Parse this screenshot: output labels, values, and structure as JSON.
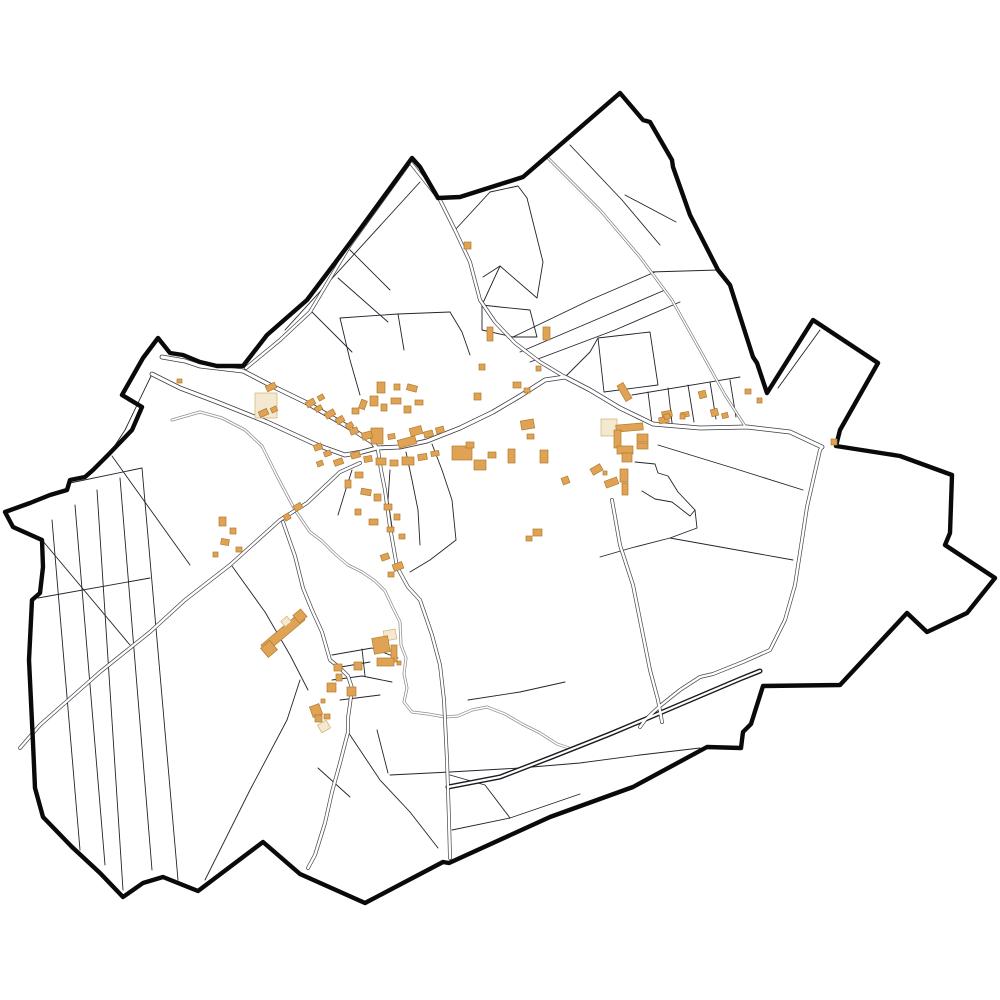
{
  "map": {
    "kind": "cadastral-commune-map",
    "background": "#ffffff",
    "colors": {
      "boundary": "#0a0a0a",
      "parcel": "#23232e",
      "road_inner": "#ffffff",
      "stream_casing": "#8f8f8f",
      "building_fill": "#e0a254",
      "building_stroke": "#b07c2e",
      "building_pale_fill": "#f4e8d0",
      "building_pale_stroke": "#cdb273"
    },
    "road_styles": {
      "major": {
        "casing": "#3a3a44",
        "cw": 4.8,
        "iw": 3.2
      },
      "minor": {
        "casing": "#44444c",
        "cw": 3.8,
        "iw": 2.4
      },
      "dark": {
        "casing": "#1b1b20",
        "cw": 5.0,
        "iw": 2.2
      },
      "track": {
        "casing": "#707070",
        "cw": 2.8,
        "iw": 1.5
      }
    },
    "boundary": "158,338 170,353 183,355 200,362 217,366 243,366 267,335 307,300 350,243 412,158 420,167 438,198 460,197 523,177 620,93 643,120 650,122 672,160 673,167 690,215 718,270 730,285 753,357 757,363 762,378 767,393 813,320 878,363 840,430 836,446 900,456 952,475 950,533 945,545 995,578 967,613 927,632 907,613 840,685 763,686 751,724 743,732 741,748 707,747 633,787 550,817 449,863 443,862 365,903 300,874 263,842 198,891 163,877 143,883 123,897 100,873 72,847 43,817 35,788 33,743 29,660 32,600 40,593 43,567 42,540 13,527 5,512 30,503 50,495 67,490 70,480 85,477 93,470 108,455 132,430 142,407 122,395 143,358",
    "roads": [
      {
        "name": "road-northwest-boundary",
        "style": "major",
        "points": "162,357 185,361 200,366 243,371 270,385 307,403 350,428 372,442 377,448"
      },
      {
        "name": "road-west-approach",
        "style": "major",
        "points": "152,374 180,388 217,402 267,422 317,445 345,455 362,452 377,448"
      },
      {
        "name": "road-main-east",
        "style": "major",
        "points": "377,448 400,447 427,441 460,428 493,412 520,396 545,380 565,377 590,390 620,408 653,424 700,428 747,427 790,432 822,447"
      },
      {
        "name": "road-north-notch",
        "style": "minor",
        "points": "246,368 280,340 310,312 350,245 410,162 440,200 455,230 470,262 480,300 495,322 515,343 540,362 565,377"
      },
      {
        "name": "road-south-east",
        "style": "minor",
        "points": "378,450 381,470 385,490 390,527 397,567 408,587 420,600 432,635 440,665 444,700 447,760 449,820 450,858"
      },
      {
        "name": "road-southwest-long",
        "style": "minor",
        "points": "360,463 340,472 307,503 280,520 230,565 185,600 150,632 100,672 40,725 20,748"
      },
      {
        "name": "road-hamlet-south",
        "style": "minor",
        "points": "283,522 295,556 303,588 312,610 322,632 330,660 340,668 348,676 352,688 350,704 348,718 348,732 340,763 332,792 325,823 315,855 308,868"
      },
      {
        "name": "road-east-south",
        "style": "minor",
        "points": "822,447 820,450 807,507 802,540 795,585 785,620 770,650 743,662 713,674 700,677 680,690 660,706 645,720 640,727"
      },
      {
        "name": "road-east-link",
        "style": "minor",
        "points": "612,500 620,545 633,585 641,625 650,670 658,700 662,722"
      },
      {
        "name": "road-dark-diagonal",
        "style": "dark",
        "points": "448,787 500,777 552,757 610,734 660,713 700,696 740,679 760,671"
      },
      {
        "name": "track-northeast",
        "style": "track",
        "points": "548,158 600,210 640,257 672,300 700,350 725,395 745,426"
      }
    ],
    "streams": [
      {
        "name": "stream-main",
        "points": "172,420 200,412 222,418 245,430 262,446 278,478 295,510 310,532 322,541 335,554 348,565 362,572 375,581 385,591 393,608 400,622 401,645 406,658 404,674 407,688 404,702 412,712 428,714 445,717 458,716 472,710 487,707 505,714 522,724 540,733 557,744 572,749"
      }
    ],
    "parcels": [
      "152,374 125,430 110,453",
      "52,520 80,850",
      "75,505 105,865",
      "97,490 123,890",
      "120,478 152,870",
      "142,468 178,880",
      "70,483 142,468",
      "38,598 150,578",
      "112,456 190,565",
      "42,540 130,645",
      "205,880 250,790 287,720 300,680",
      "232,566 265,612 290,655 308,690",
      "348,732 380,780 410,812 438,848",
      "390,775 450,772 520,768 580,763 640,755 700,748",
      "377,730 388,773",
      "452,830 510,818 580,794",
      "450,775 485,785 510,818",
      "318,768 350,797",
      "455,230 490,192 518,186 527,198",
      "527,198 543,262 537,298 500,266 482,305",
      "500,266 483,277",
      "482,305 500,307 530,310 537,337 513,337 482,330 482,305",
      "513,337 590,300 655,272",
      "520,352 600,318 665,290",
      "530,362 615,330 680,302",
      "570,145 622,200 660,245",
      "650,272 718,270",
      "625,195 676,222",
      "285,330 420,182",
      "350,250 390,290",
      "310,310 352,352",
      "338,278 388,322",
      "340,318 398,314 450,312",
      "450,312 462,332 470,355",
      "340,318 350,360 360,395",
      "398,314 404,350",
      "598,338 650,332 658,385 604,392 598,338",
      "565,377 590,352 598,338",
      "632,395 740,377",
      "648,392 652,424",
      "668,388 672,423",
      "688,385 694,422",
      "710,382 716,419",
      "730,380 736,417",
      "658,445 733,468 803,490",
      "670,538 793,560",
      "600,557 631,548 670,538",
      "635,462 655,464 658,473 668,476 678,492 695,510 690,516 672,502 655,499 642,491",
      "695,510 697,528 670,538",
      "778,388 820,330",
      "332,655 372,648 398,658",
      "335,668 370,662",
      "332,680 362,676 392,682",
      "340,700 380,695",
      "362,649 365,676",
      "468,700 520,692 565,682",
      "352,470 345,492 338,515",
      "390,470 388,500 392,527",
      "406,452 412,480 418,510 420,545",
      "432,444 442,470 452,500 456,540",
      "456,540 430,560 410,572"
    ],
    "buildings": [
      [
        177,
        379,
        5,
        4,
        0,
        "main"
      ],
      [
        255,
        393,
        22,
        25,
        0,
        "pale"
      ],
      [
        266,
        384,
        10,
        6,
        -25,
        "main"
      ],
      [
        259,
        410,
        9,
        6,
        -25,
        "main"
      ],
      [
        271,
        407,
        6,
        5,
        -25,
        "main"
      ],
      [
        306,
        400,
        9,
        6,
        -30,
        "main"
      ],
      [
        315,
        406,
        7,
        5,
        -30,
        "main"
      ],
      [
        325,
        411,
        10,
        6,
        -30,
        "main"
      ],
      [
        336,
        417,
        8,
        6,
        -30,
        "main"
      ],
      [
        346,
        423,
        7,
        5,
        -30,
        "main"
      ],
      [
        318,
        395,
        6,
        5,
        -30,
        "main"
      ],
      [
        371,
        428,
        12,
        16,
        0,
        "main"
      ],
      [
        398,
        438,
        18,
        8,
        -15,
        "main"
      ],
      [
        352,
        408,
        7,
        6,
        0,
        "main"
      ],
      [
        360,
        400,
        6,
        9,
        20,
        "main"
      ],
      [
        370,
        396,
        8,
        10,
        0,
        "main"
      ],
      [
        381,
        404,
        6,
        7,
        0,
        "main"
      ],
      [
        391,
        398,
        10,
        6,
        0,
        "main"
      ],
      [
        404,
        406,
        7,
        7,
        0,
        "main"
      ],
      [
        415,
        400,
        8,
        5,
        0,
        "main"
      ],
      [
        377,
        382,
        8,
        11,
        0,
        "main"
      ],
      [
        394,
        384,
        6,
        6,
        0,
        "main"
      ],
      [
        407,
        385,
        10,
        6,
        15,
        "main"
      ],
      [
        350,
        428,
        8,
        6,
        -20,
        "main"
      ],
      [
        362,
        432,
        10,
        7,
        -15,
        "main"
      ],
      [
        388,
        434,
        7,
        5,
        -10,
        "main"
      ],
      [
        410,
        427,
        12,
        8,
        -15,
        "main"
      ],
      [
        424,
        431,
        9,
        6,
        -15,
        "main"
      ],
      [
        436,
        427,
        8,
        6,
        -15,
        "main"
      ],
      [
        351,
        452,
        9,
        6,
        -15,
        "main"
      ],
      [
        364,
        456,
        8,
        6,
        -10,
        "main"
      ],
      [
        376,
        458,
        10,
        7,
        0,
        "main"
      ],
      [
        390,
        460,
        8,
        6,
        0,
        "main"
      ],
      [
        402,
        457,
        12,
        8,
        0,
        "main"
      ],
      [
        418,
        454,
        9,
        6,
        -10,
        "main"
      ],
      [
        431,
        451,
        8,
        5,
        -10,
        "main"
      ],
      [
        355,
        472,
        8,
        6,
        0,
        "main"
      ],
      [
        345,
        480,
        6,
        8,
        0,
        "main"
      ],
      [
        361,
        489,
        10,
        6,
        10,
        "main"
      ],
      [
        374,
        494,
        7,
        7,
        0,
        "main"
      ],
      [
        384,
        504,
        8,
        6,
        0,
        "main"
      ],
      [
        394,
        514,
        6,
        6,
        0,
        "main"
      ],
      [
        369,
        519,
        9,
        6,
        0,
        "main"
      ],
      [
        355,
        509,
        6,
        6,
        0,
        "main"
      ],
      [
        387,
        527,
        7,
        5,
        0,
        "main"
      ],
      [
        399,
        534,
        6,
        5,
        0,
        "main"
      ],
      [
        314,
        444,
        8,
        6,
        -20,
        "main"
      ],
      [
        324,
        451,
        7,
        5,
        -20,
        "main"
      ],
      [
        334,
        459,
        9,
        6,
        -20,
        "main"
      ],
      [
        317,
        461,
        6,
        5,
        -20,
        "main"
      ],
      [
        294,
        504,
        8,
        6,
        -30,
        "main"
      ],
      [
        284,
        514,
        6,
        6,
        -30,
        "main"
      ],
      [
        219,
        517,
        7,
        9,
        0,
        "main"
      ],
      [
        230,
        528,
        6,
        6,
        0,
        "main"
      ],
      [
        221,
        539,
        8,
        6,
        10,
        "main"
      ],
      [
        236,
        547,
        6,
        5,
        0,
        "main"
      ],
      [
        213,
        552,
        5,
        5,
        0,
        "main"
      ],
      [
        452,
        446,
        20,
        14,
        0,
        "main"
      ],
      [
        474,
        460,
        12,
        10,
        0,
        "main"
      ],
      [
        488,
        452,
        8,
        6,
        0,
        "main"
      ],
      [
        466,
        442,
        8,
        6,
        0,
        "main"
      ],
      [
        508,
        449,
        7,
        14,
        0,
        "main"
      ],
      [
        540,
        450,
        8,
        13,
        0,
        "main"
      ],
      [
        521,
        420,
        13,
        9,
        -10,
        "main"
      ],
      [
        527,
        434,
        7,
        5,
        0,
        "main"
      ],
      [
        487,
        327,
        6,
        14,
        0,
        "main"
      ],
      [
        543,
        327,
        7,
        13,
        0,
        "main"
      ],
      [
        479,
        364,
        6,
        6,
        0,
        "main"
      ],
      [
        474,
        393,
        7,
        7,
        0,
        "main"
      ],
      [
        513,
        382,
        8,
        6,
        0,
        "main"
      ],
      [
        524,
        388,
        6,
        5,
        0,
        "main"
      ],
      [
        536,
        366,
        5,
        5,
        0,
        "main"
      ],
      [
        464,
        242,
        7,
        7,
        0,
        "main"
      ],
      [
        381,
        554,
        8,
        6,
        -20,
        "main"
      ],
      [
        393,
        563,
        10,
        7,
        -20,
        "main"
      ],
      [
        388,
        572,
        6,
        5,
        0,
        "main"
      ],
      [
        533,
        529,
        9,
        7,
        0,
        "main"
      ],
      [
        526,
        536,
        6,
        5,
        0,
        "main"
      ],
      [
        601,
        419,
        16,
        17,
        0,
        "pale"
      ],
      [
        616,
        424,
        27,
        7,
        -5,
        "main"
      ],
      [
        614,
        430,
        7,
        18,
        0,
        "main"
      ],
      [
        637,
        434,
        11,
        8,
        0,
        "main"
      ],
      [
        637,
        443,
        11,
        6,
        0,
        "main"
      ],
      [
        617,
        446,
        16,
        8,
        0,
        "main"
      ],
      [
        622,
        453,
        10,
        9,
        0,
        "main"
      ],
      [
        620,
        469,
        8,
        13,
        0,
        "main"
      ],
      [
        605,
        479,
        13,
        7,
        -20,
        "main"
      ],
      [
        622,
        483,
        6,
        12,
        0,
        "main"
      ],
      [
        591,
        466,
        11,
        7,
        -30,
        "main"
      ],
      [
        603,
        471,
        4,
        4,
        0,
        "main"
      ],
      [
        562,
        477,
        7,
        7,
        -20,
        "main"
      ],
      [
        662,
        411,
        10,
        6,
        -10,
        "main"
      ],
      [
        681,
        412,
        8,
        5,
        -10,
        "main"
      ],
      [
        659,
        417,
        10,
        6,
        -10,
        "main"
      ],
      [
        621,
        383,
        7,
        18,
        -30,
        "main"
      ],
      [
        699,
        391,
        7,
        7,
        -15,
        "main"
      ],
      [
        711,
        409,
        7,
        7,
        -15,
        "main"
      ],
      [
        722,
        413,
        6,
        5,
        -15,
        "main"
      ],
      [
        664,
        414,
        6,
        5,
        -15,
        "main"
      ],
      [
        680,
        414,
        5,
        5,
        0,
        "main"
      ],
      [
        745,
        389,
        6,
        5,
        0,
        "main"
      ],
      [
        757,
        398,
        5,
        5,
        0,
        "main"
      ],
      [
        831,
        439,
        6,
        6,
        0,
        "main"
      ],
      [
        384,
        630,
        12,
        10,
        -10,
        "pale"
      ],
      [
        373,
        637,
        16,
        16,
        -10,
        "main"
      ],
      [
        391,
        645,
        6,
        17,
        0,
        "main"
      ],
      [
        377,
        658,
        17,
        8,
        0,
        "main"
      ],
      [
        397,
        661,
        4,
        4,
        0,
        "main"
      ],
      [
        334,
        664,
        8,
        7,
        0,
        "main"
      ],
      [
        354,
        662,
        8,
        8,
        0,
        "main"
      ],
      [
        336,
        674,
        6,
        7,
        0,
        "main"
      ],
      [
        327,
        683,
        9,
        9,
        0,
        "main"
      ],
      [
        347,
        687,
        9,
        9,
        0,
        "main"
      ],
      [
        321,
        699,
        4,
        4,
        0,
        "main"
      ],
      [
        311,
        705,
        10,
        11,
        -20,
        "main"
      ],
      [
        315,
        715,
        7,
        7,
        0,
        "main"
      ],
      [
        324,
        714,
        6,
        5,
        0,
        "main"
      ],
      [
        319,
        722,
        10,
        9,
        -30,
        "pale"
      ],
      [
        258,
        628,
        50,
        9,
        -40,
        "main"
      ],
      [
        263,
        643,
        12,
        12,
        -40,
        "main"
      ],
      [
        295,
        611,
        10,
        10,
        -40,
        "main"
      ],
      [
        282,
        618,
        8,
        7,
        -40,
        "pale"
      ]
    ]
  }
}
